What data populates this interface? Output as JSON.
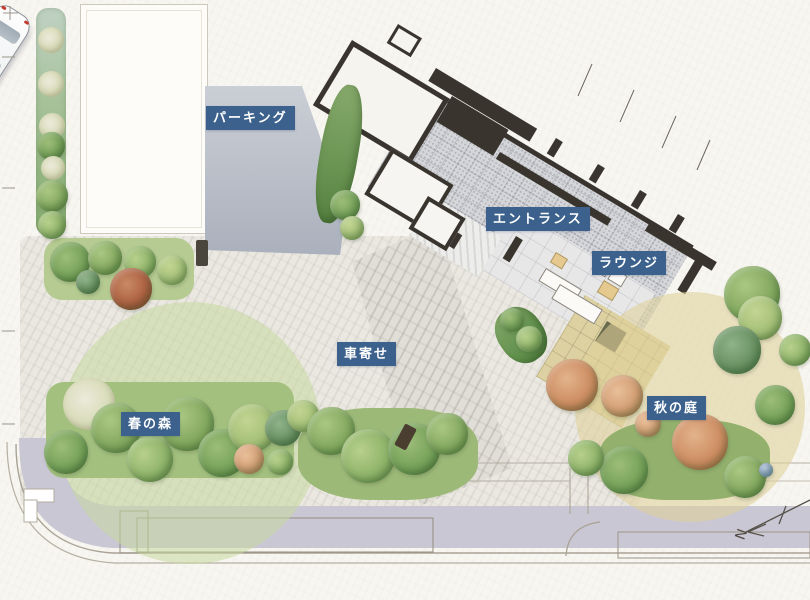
{
  "site_plan": {
    "areas": [
      {
        "id": "parking",
        "label": "パーキング"
      },
      {
        "id": "entrance",
        "label": "エントランス"
      },
      {
        "id": "lounge",
        "label": "ラウンジ"
      },
      {
        "id": "porte_cochere",
        "label": "車寄せ"
      },
      {
        "id": "spring_forest",
        "label": "春の森"
      },
      {
        "id": "autumn_garden",
        "label": "秋の庭"
      }
    ],
    "compass": {
      "north_label": "N"
    },
    "colors": {
      "label_background": "#3b618c",
      "label_text": "#ffffff",
      "spring_overlay": "#c7d99e",
      "autumn_overlay": "#ded09a",
      "paper": "#f8f6f1",
      "parking_gray": "#b4b9c3",
      "building_wall": "#39352e",
      "tile_floor": "#d5d6da",
      "sidewalk": "#cac7d4",
      "foliage_green": "#7fa55c",
      "foliage_orange": "#cc8a5f"
    }
  }
}
